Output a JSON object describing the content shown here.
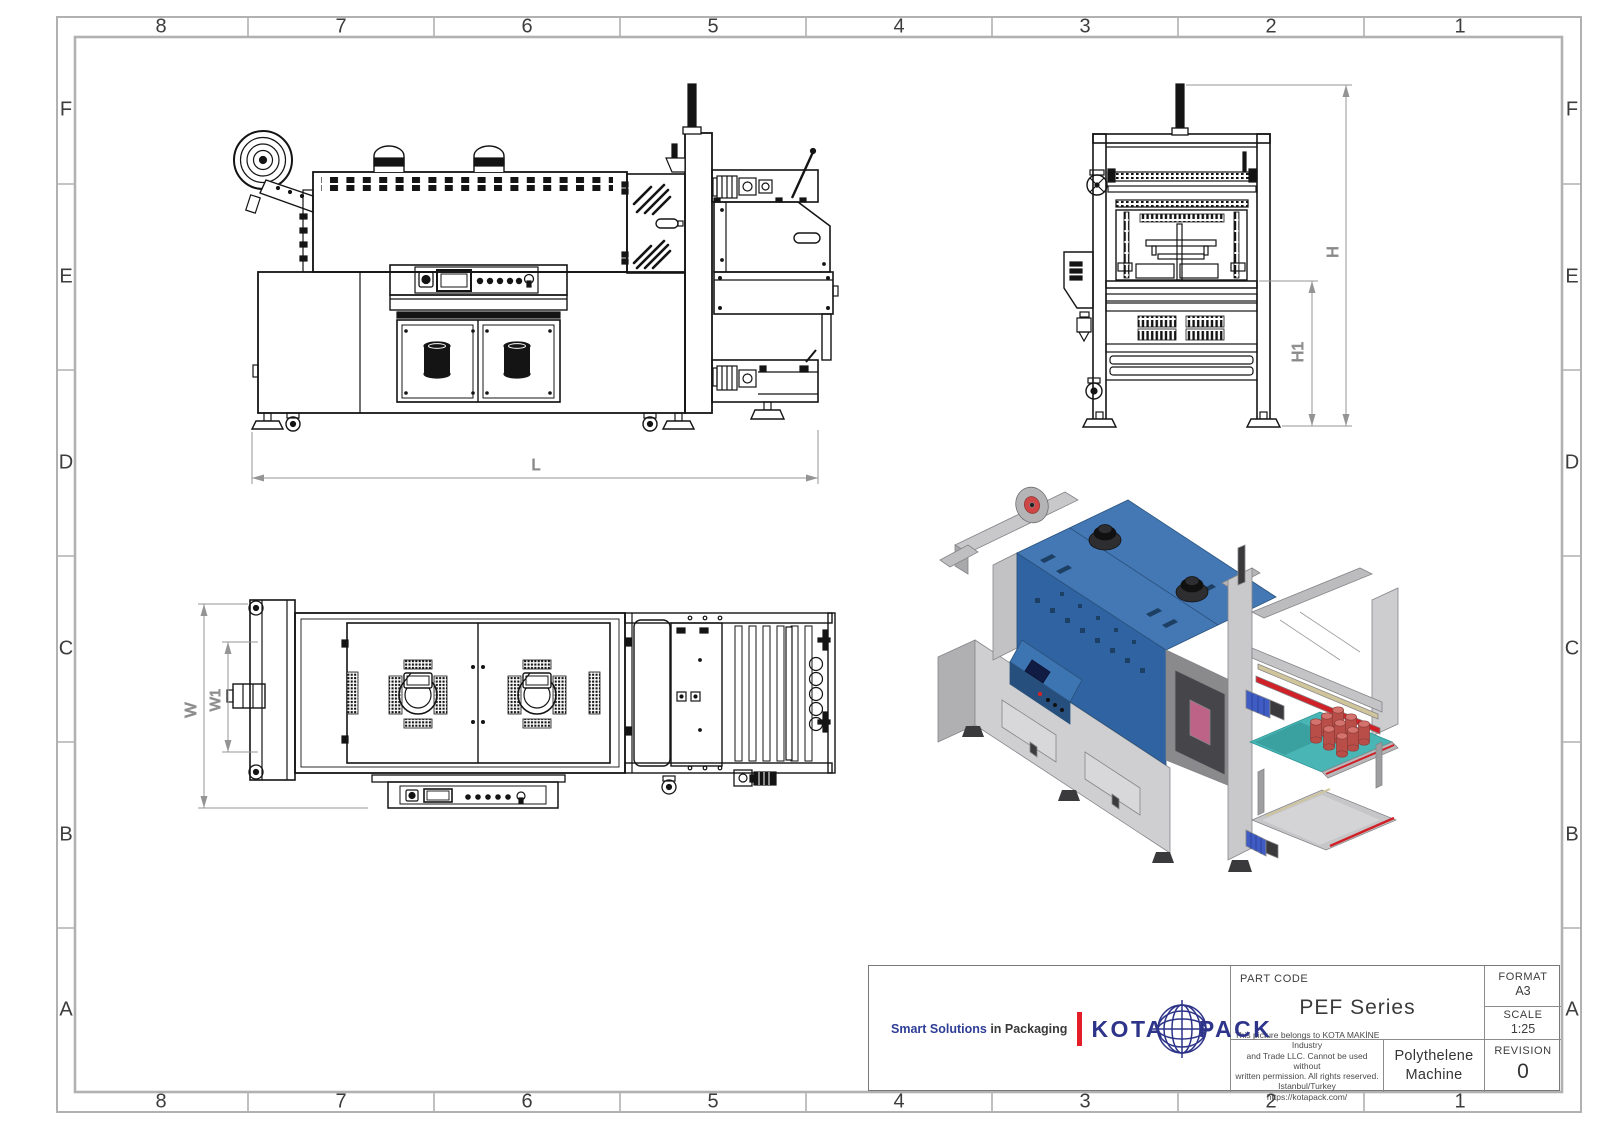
{
  "frame": {
    "cols": [
      "8",
      "7",
      "6",
      "5",
      "4",
      "3",
      "2",
      "1"
    ],
    "rows": [
      "F",
      "E",
      "D",
      "C",
      "B",
      "A"
    ]
  },
  "views": {
    "front": {
      "dim_length": "L"
    },
    "side": {
      "dim_height": "H",
      "dim_height_inner": "H1"
    },
    "top": {
      "dim_width": "W",
      "dim_width_inner": "W1"
    }
  },
  "title_block": {
    "part_code_label": "PART CODE",
    "part_code_value": "PEF Series",
    "format_label": "FORMAT",
    "format_value": "A3",
    "scale_label": "SCALE",
    "scale_value": "1:25",
    "revision_label": "REVISION",
    "revision_value": "0",
    "description": "Polythelene Machine",
    "disclaimer": [
      "This picture belongs to KOTA MAKİNE Industry",
      "and Trade LLC. Cannot be used without",
      "written permission. All rights reserved.",
      "Istanbul/Turkey",
      "https://kotapack.com/"
    ],
    "tagline_highlight": "Smart Solutions",
    "tagline_rest": " in Packaging",
    "brand_word1": "KOTA",
    "brand_word2": "PACK"
  },
  "colors": {
    "accent_red": "#e31e26",
    "brand_navy": "#2d3489",
    "tagline_blue": "#2e3d96",
    "machine_blue": "#4478b5",
    "machine_blue_dark": "#2f63a2",
    "machine_blue_panel": "#3d74b2",
    "conveyor_teal": "#49b5b5",
    "bottle_red": "#b94e49",
    "stripe_red": "#cf2127",
    "frame_gray": "#b1b1b1",
    "dim_gray": "#8a8a8a"
  }
}
